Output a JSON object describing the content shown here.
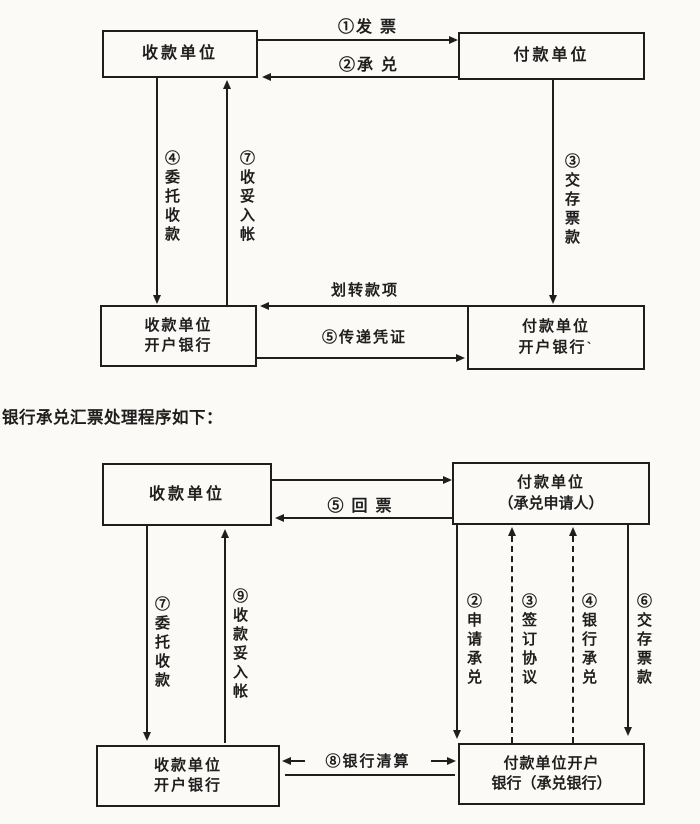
{
  "page": {
    "background": "#fbfaf7",
    "ink": "#1e1e1e"
  },
  "heading": {
    "text": "银行承兑汇票处理程序如下："
  },
  "d1": {
    "box_payee": "收款单位",
    "box_payer": "付款单位",
    "box_payee_bank_line1": "收款单位",
    "box_payee_bank_line2": "开户银行",
    "box_payer_bank_line1": "付款单位",
    "box_payer_bank_line2": "开户银行`",
    "label_invoice": "①发 票",
    "label_accept": "②承 兑",
    "label_entrust_collect": "④委托收款",
    "label_credit_account": "⑦收妥入帐",
    "label_deposit_funds": "③交存票款",
    "label_transfer_funds": "划转款项",
    "label_pass_voucher": "⑤传递凭证"
  },
  "d2": {
    "box_payee": "收款单位",
    "box_payer_line1": "付款单位",
    "box_payer_line2": "（承兑申请人）",
    "box_payee_bank_line1": "收款单位",
    "box_payee_bank_line2": "开户银行",
    "box_payer_bank_line1": "付款单位开户",
    "box_payer_bank_line2": "银行（承兑银行）",
    "label_return_bill": "⑤ 回 票",
    "label_entrust_collect": "⑦委托收款",
    "label_collect_credit": "⑨收款妥入帐",
    "label_apply_accept": "②申请承兑",
    "label_sign_agreement": "③签订协议",
    "label_bank_accept": "④银行承兑",
    "label_deposit_funds": "⑥交存票款",
    "label_bank_clearing": "⑧银行清算"
  }
}
